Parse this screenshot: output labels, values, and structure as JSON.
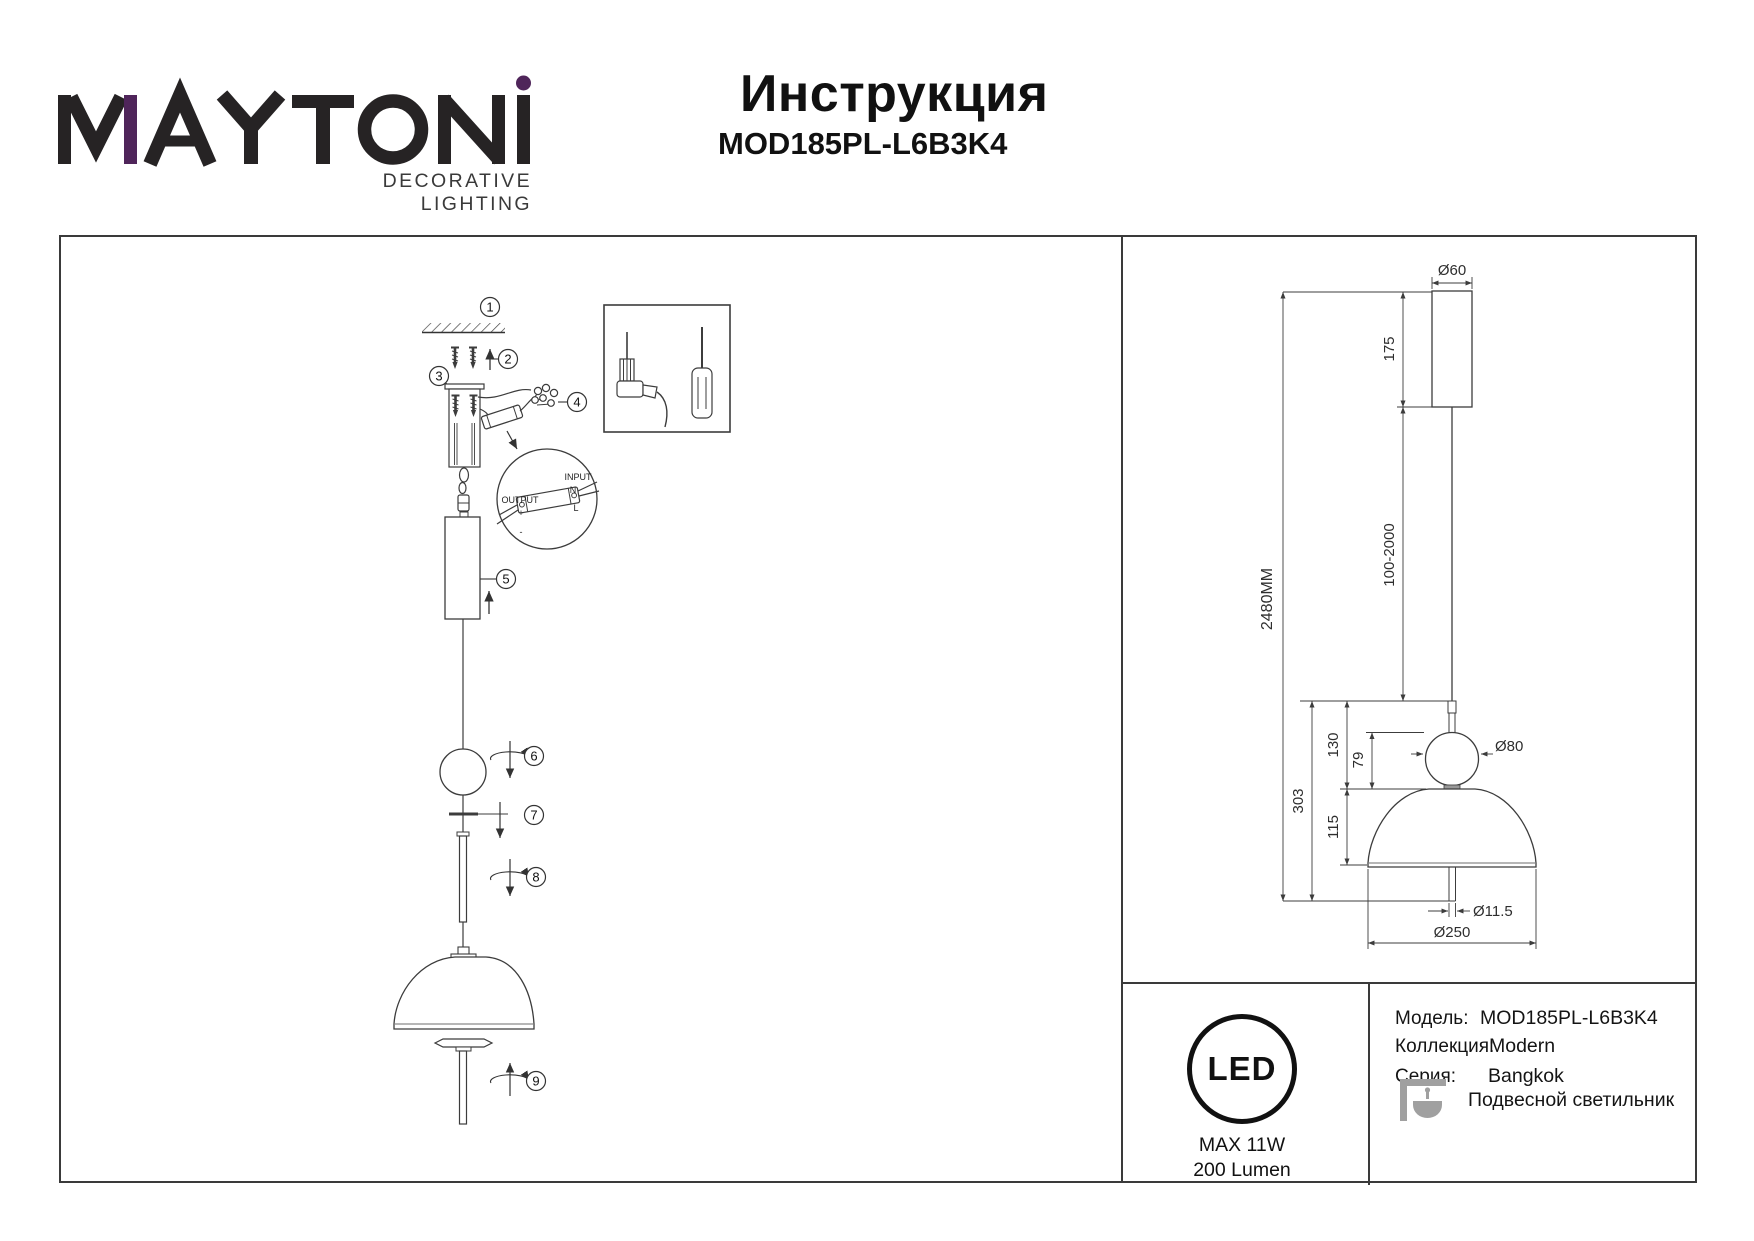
{
  "header": {
    "brand": {
      "name": "MAYTONI",
      "tagline": "DECORATIVE LIGHTING"
    },
    "title": "Инструкция",
    "model": "MOD185PL-L6B3K4"
  },
  "assembly_panel": {
    "steps": [
      "1",
      "2",
      "3",
      "4",
      "5",
      "6",
      "7",
      "8",
      "9"
    ],
    "wiring_detail": {
      "output_label": "OUTPUT",
      "output_plus": "+",
      "output_minus": "-",
      "input_label": "INPUT",
      "input_neutral": "N",
      "input_line": "L"
    }
  },
  "dimensions_panel": {
    "canopy_diameter": "Ø60",
    "canopy_height": "175",
    "suspension_length": "100-2000",
    "total_height": "2480MM",
    "ball_diameter": "Ø80",
    "upper_section_height": "130",
    "ball_section_height": "79",
    "fixture_height": "303",
    "shade_height": "115",
    "stem_diameter": "Ø11.5",
    "shade_diameter": "Ø250"
  },
  "spec_table": {
    "led_badge": {
      "label": "LED",
      "max_power": "MAX 11W",
      "luminous_flux": "200 Lumen"
    },
    "rows": [
      {
        "label": "Модель:",
        "value": "MOD185PL-L6B3K4"
      },
      {
        "label": "Коллекция:",
        "value": "Modern"
      },
      {
        "label": "Серия:",
        "value": "Bangkok"
      },
      {
        "label": "",
        "value": "Подвесной светильник"
      }
    ]
  },
  "colors": {
    "brand_accent": "#4f255a",
    "line": "#3c3c3c",
    "icon_gray": "#a0a0a0"
  }
}
